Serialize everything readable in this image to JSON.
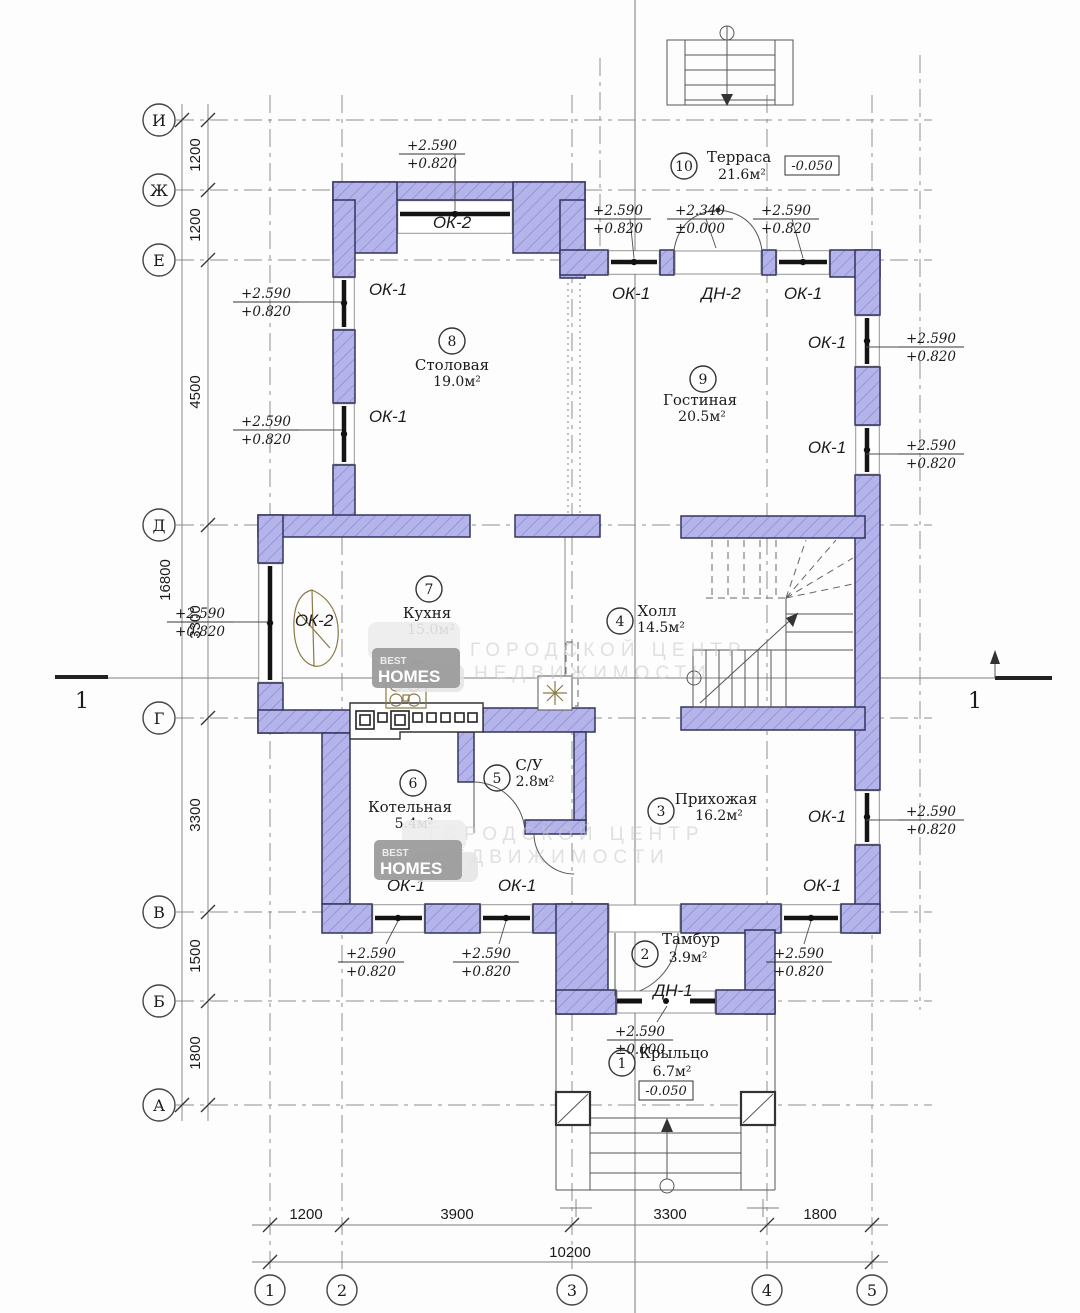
{
  "drawing": {
    "section_label": "1",
    "watermark": {
      "line1": "ГОРОДСКОЙ ЦЕНТР",
      "line2": "НЕДВИЖИМОСТИ",
      "logo_top": "BEST",
      "logo_main": "HOMES"
    }
  },
  "dims_total": {
    "left": "16800",
    "bottom": "10200"
  },
  "row_axes": [
    {
      "label": "И",
      "y": 120
    },
    {
      "label": "Ж",
      "y": 190
    },
    {
      "label": "Е",
      "y": 260
    },
    {
      "label": "Д",
      "y": 525
    },
    {
      "label": "Г",
      "y": 718
    },
    {
      "label": "В",
      "y": 912
    },
    {
      "label": "Б",
      "y": 1001
    },
    {
      "label": "А",
      "y": 1105
    }
  ],
  "col_axes": [
    {
      "label": "1",
      "x": 270
    },
    {
      "label": "2",
      "x": 342
    },
    {
      "label": "3",
      "x": 572
    },
    {
      "label": "4",
      "x": 767
    },
    {
      "label": "5",
      "x": 872
    }
  ],
  "dims_left": [
    {
      "text": "1200",
      "y": 155
    },
    {
      "text": "1200",
      "y": 225
    },
    {
      "text": "4500",
      "y": 392
    },
    {
      "text": "3300",
      "y": 622
    },
    {
      "text": "3300",
      "y": 815
    },
    {
      "text": "1500",
      "y": 956
    },
    {
      "text": "1800",
      "y": 1053
    }
  ],
  "dims_bottom": [
    {
      "text": "1200",
      "x": 306
    },
    {
      "text": "3900",
      "x": 457
    },
    {
      "text": "3300",
      "x": 670
    },
    {
      "text": "1800",
      "x": 820
    }
  ],
  "rooms": [
    {
      "num": "1",
      "name": "Крыльцо",
      "area": "6.7м²",
      "cx": 622,
      "cy": 1063,
      "tx": 674,
      "ty": 1058,
      "ax": 672,
      "ay": 1076
    },
    {
      "num": "2",
      "name": "Тамбур",
      "area": "3.9м²",
      "cx": 645,
      "cy": 954,
      "tx": 691,
      "ty": 944,
      "ax": 688,
      "ay": 962
    },
    {
      "num": "3",
      "name": "Прихожая",
      "area": "16.2м²",
      "cx": 661,
      "cy": 811,
      "tx": 716,
      "ty": 804,
      "ax": 719,
      "ay": 820
    },
    {
      "num": "4",
      "name": "Холл",
      "area": "14.5м²",
      "cx": 620,
      "cy": 621,
      "tx": 657,
      "ty": 616,
      "ax": 661,
      "ay": 632
    },
    {
      "num": "5",
      "name": "С/У",
      "area": "2.8м²",
      "cx": 497,
      "cy": 778,
      "tx": 529,
      "ty": 770,
      "ax": 535,
      "ay": 786
    },
    {
      "num": "6",
      "name": "Котельная",
      "area": "5.4м²",
      "cx": 413,
      "cy": 783,
      "tx": 410,
      "ty": 812,
      "ax": 414,
      "ay": 828
    },
    {
      "num": "7",
      "name": "Кухня",
      "area": "15.0м²",
      "cx": 429,
      "cy": 589,
      "tx": 427,
      "ty": 618,
      "ax": 431,
      "ay": 634
    },
    {
      "num": "8",
      "name": "Столовая",
      "area": "19.0м²",
      "cx": 452,
      "cy": 341,
      "tx": 452,
      "ty": 370,
      "ax": 457,
      "ay": 386
    },
    {
      "num": "9",
      "name": "Гостиная",
      "area": "20.5м²",
      "cx": 703,
      "cy": 379,
      "tx": 700,
      "ty": 405,
      "ax": 702,
      "ay": 421
    },
    {
      "num": "10",
      "name": "Терраса",
      "area": "21.6м²",
      "cx": 684,
      "cy": 166,
      "tx": 739,
      "ty": 162,
      "ax": 742,
      "ay": 179
    }
  ],
  "opening_labels": [
    {
      "text": "ОК-2",
      "x": 452,
      "y": 228
    },
    {
      "text": "ОК-1",
      "x": 388,
      "y": 295
    },
    {
      "text": "ОК-1",
      "x": 388,
      "y": 422
    },
    {
      "text": "ОК-2",
      "x": 314,
      "y": 626
    },
    {
      "text": "ОК-1",
      "x": 631,
      "y": 299
    },
    {
      "text": "ДН-2",
      "x": 721,
      "y": 299
    },
    {
      "text": "ОК-1",
      "x": 803,
      "y": 299
    },
    {
      "text": "ОК-1",
      "x": 827,
      "y": 348
    },
    {
      "text": "ОК-1",
      "x": 827,
      "y": 453
    },
    {
      "text": "ОК-1",
      "x": 827,
      "y": 822
    },
    {
      "text": "ОК-1",
      "x": 406,
      "y": 891
    },
    {
      "text": "ОК-1",
      "x": 517,
      "y": 891
    },
    {
      "text": "ОК-1",
      "x": 822,
      "y": 891
    },
    {
      "text": "ДН-1",
      "x": 673,
      "y": 996
    }
  ],
  "elevations": [
    {
      "top": "+2.590",
      "bottom": "+0.820",
      "x": 432,
      "y": 140
    },
    {
      "top": "+2.590",
      "bottom": "+0.820",
      "x": 266,
      "y": 288
    },
    {
      "top": "+2.590",
      "bottom": "+0.820",
      "x": 266,
      "y": 416
    },
    {
      "top": "+2.590",
      "bottom": "+0.820",
      "x": 200,
      "y": 608
    },
    {
      "top": "+2.590",
      "bottom": "+0.820",
      "x": 618,
      "y": 205
    },
    {
      "top": "+2.340",
      "bottom": "±0.000",
      "x": 700,
      "y": 205
    },
    {
      "top": "+2.590",
      "bottom": "+0.820",
      "x": 786,
      "y": 205
    },
    {
      "top": "+2.590",
      "bottom": "+0.820",
      "x": 931,
      "y": 333
    },
    {
      "top": "+2.590",
      "bottom": "+0.820",
      "x": 931,
      "y": 440
    },
    {
      "top": "+2.590",
      "bottom": "+0.820",
      "x": 931,
      "y": 806
    },
    {
      "top": "+2.590",
      "bottom": "+0.820",
      "x": 371,
      "y": 948
    },
    {
      "top": "+2.590",
      "bottom": "+0.820",
      "x": 486,
      "y": 948
    },
    {
      "top": "+2.590",
      "bottom": "+0.820",
      "x": 799,
      "y": 948
    },
    {
      "top": "+2.590",
      "bottom": "±0.000",
      "x": 640,
      "y": 1026
    }
  ],
  "level_marks": [
    {
      "text": "-0.050",
      "x": 812,
      "y": 167
    },
    {
      "text": "-0.050",
      "x": 666,
      "y": 1092
    }
  ]
}
